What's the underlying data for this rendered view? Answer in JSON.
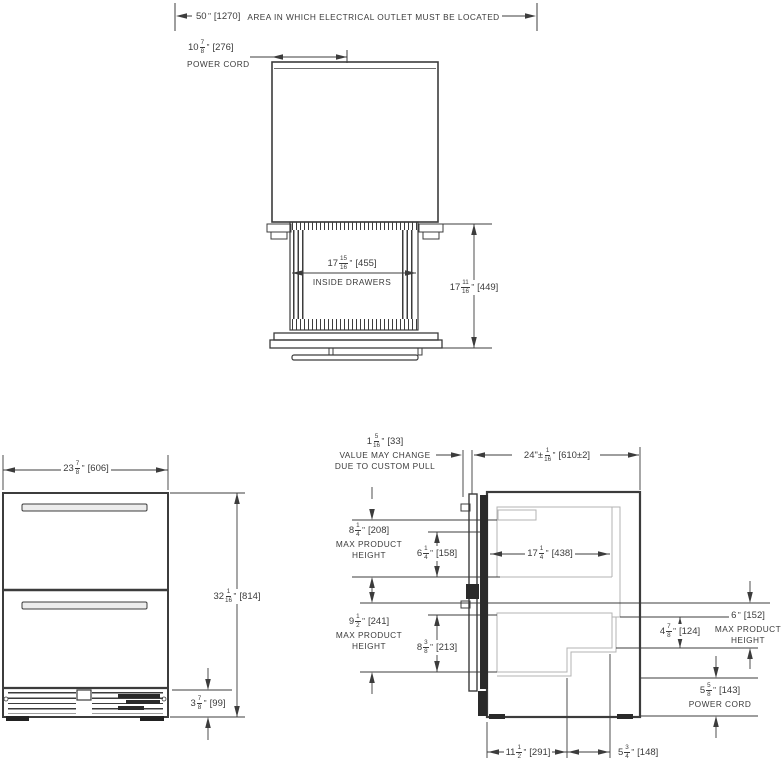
{
  "accent_colors": {
    "line": "#3c3c3c",
    "gray_line": "#b3b3b3",
    "background": "#ffffff"
  },
  "top_view": {
    "outlet_note": {
      "dim": {
        "w": "50",
        "u": "\"",
        "mm": "1270"
      },
      "label": "AREA IN WHICH ELECTRICAL OUTLET MUST BE LOCATED"
    },
    "power_cord": {
      "dim": {
        "w": "10",
        "n": "7",
        "d": "8",
        "u": "\"",
        "mm": "276"
      },
      "label": "POWER CORD"
    },
    "inside_drawers": {
      "dim": {
        "w": "17",
        "n": "15",
        "d": "16",
        "u": "\"",
        "mm": "455"
      },
      "label": "INSIDE DRAWERS"
    },
    "depth_dim": {
      "w": "17",
      "n": "11",
      "d": "16",
      "u": "\"",
      "mm": "449"
    }
  },
  "front_view": {
    "width_dim": {
      "w": "23",
      "n": "7",
      "d": "8",
      "u": "\"",
      "mm": "606"
    },
    "height_dim": {
      "w": "32",
      "n": "1",
      "d": "16",
      "u": "\"",
      "mm": "814"
    },
    "grille_dim": {
      "w": "3",
      "n": "7",
      "d": "8",
      "u": "\"",
      "mm": "99"
    }
  },
  "side_view": {
    "pull_dim": {
      "w": "1",
      "n": "5",
      "d": "16",
      "u": "\"",
      "mm": "33"
    },
    "pull_note_line1": "VALUE MAY CHANGE",
    "pull_note_line2": "DUE TO CUSTOM PULL",
    "depth_dim": {
      "w": "24\"±",
      "n": "1",
      "d": "16",
      "u": "\"",
      "mm": "610±2"
    },
    "top_product": {
      "dim": {
        "w": "8",
        "n": "1",
        "d": "4",
        "u": "\"",
        "mm": "208"
      },
      "label_line1": "MAX PRODUCT",
      "label_line2": "HEIGHT"
    },
    "top_inner_dim": {
      "w": "6",
      "n": "1",
      "d": "4",
      "u": "\"",
      "mm": "158"
    },
    "drawer_depth_dim": {
      "w": "17",
      "n": "1",
      "d": "4",
      "u": "\"",
      "mm": "438"
    },
    "bottom_product": {
      "dim": {
        "w": "9",
        "n": "1",
        "d": "2",
        "u": "\"",
        "mm": "241"
      },
      "label_line1": "MAX PRODUCT",
      "label_line2": "HEIGHT"
    },
    "bottom_inner_dim": {
      "w": "8",
      "n": "3",
      "d": "8",
      "u": "\"",
      "mm": "213"
    },
    "right_product": {
      "dim": {
        "w": "6",
        "u": "\"",
        "mm": "152"
      },
      "label_line1": "MAX PRODUCT",
      "label_line2": "HEIGHT"
    },
    "step_height_dim": {
      "w": "4",
      "n": "7",
      "d": "8",
      "u": "\"",
      "mm": "124"
    },
    "power_cord": {
      "dim": {
        "w": "5",
        "n": "5",
        "d": "8",
        "u": "\"",
        "mm": "143"
      },
      "label": "POWER CORD"
    },
    "floor_depth_dim": {
      "w": "11",
      "n": "1",
      "d": "2",
      "u": "\"",
      "mm": "291"
    },
    "step_depth_dim": {
      "w": "5",
      "n": "3",
      "d": "4",
      "u": "\"",
      "mm": "148"
    }
  }
}
